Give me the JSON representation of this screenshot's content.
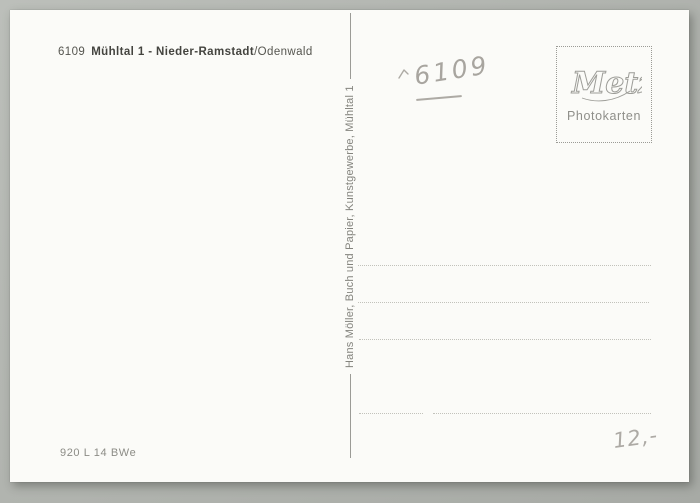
{
  "card": {
    "header": {
      "postal_code": "6109",
      "title_bold": "Mühltal 1 - Nieder-Ramstadt",
      "title_region": "/Odenwald"
    },
    "stamp_box": {
      "logo_text": "Metz",
      "caption": "Photokarten"
    },
    "publisher_line": {
      "text": "Hans Möller, Buch und Papier, Kunstgewerbe, Mühltal 1"
    },
    "address_section": {
      "line_count": 4
    },
    "handwriting": {
      "code_note": "6109",
      "price_note": "12,-"
    },
    "footer": {
      "print_code": "920 L 14 BWe"
    }
  },
  "colors": {
    "page_background": "#b1b4af",
    "card_background": "#fbfbf8",
    "print_dark": "#44443f",
    "print_gray": "#84847e",
    "dotted_line": "#c2c2bb",
    "stamp_border": "#9b9b96",
    "pencil": "#94908a"
  }
}
